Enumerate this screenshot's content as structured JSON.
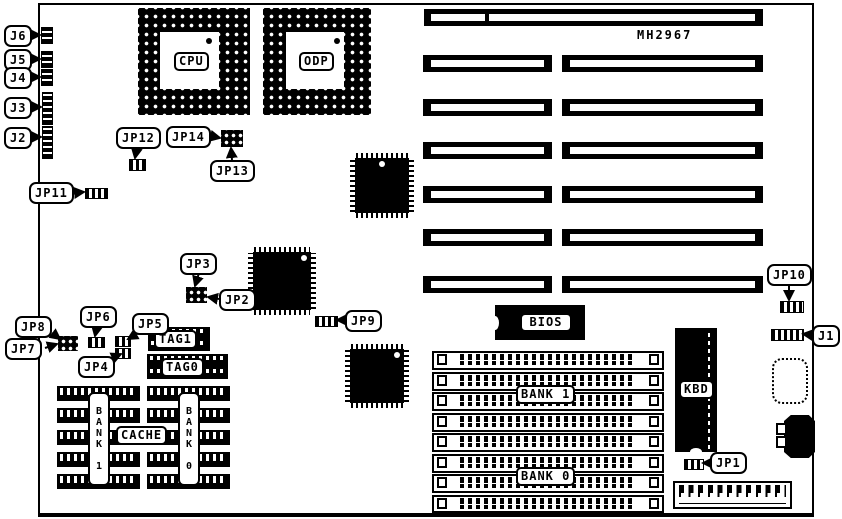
{
  "board": {
    "model_number": "MH2967"
  },
  "sockets": {
    "cpu": "CPU",
    "odp": "ODP"
  },
  "chips": {
    "bios": "BIOS",
    "keyboard": "KBD"
  },
  "cache": {
    "label": "CACHE",
    "bank1_vertical": "BANK 1",
    "bank0_vertical": "BANK 0",
    "tag1": "TAG1",
    "tag0": "TAG0"
  },
  "memory_banks": {
    "bank1": "BANK 1",
    "bank0": "BANK 0"
  },
  "jumpers": {
    "j1": "J1",
    "j2": "J2",
    "j3": "J3",
    "j4": "J4",
    "j5": "J5",
    "j6": "J6",
    "jp1": "JP1",
    "jp2": "JP2",
    "jp3": "JP3",
    "jp4": "JP4",
    "jp5": "JP5",
    "jp6": "JP6",
    "jp7": "JP7",
    "jp8": "JP8",
    "jp9": "JP9",
    "jp10": "JP10",
    "jp11": "JP11",
    "jp12": "JP12",
    "jp13": "JP13",
    "jp14": "JP14"
  }
}
